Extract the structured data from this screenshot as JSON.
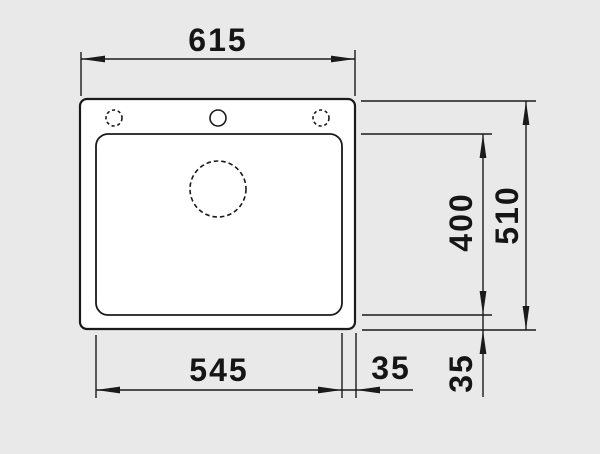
{
  "drawing": {
    "type": "sink-top-view-dimension-drawing",
    "dimensions": {
      "overall_width": "615",
      "overall_height": "510",
      "bowl_width": "545",
      "bowl_height": "400",
      "rim_right": "35",
      "rim_bottom": "35"
    },
    "colors": {
      "background": "#e9e9e9",
      "line": "#1a1a1a",
      "surface": "#ffffff"
    }
  }
}
